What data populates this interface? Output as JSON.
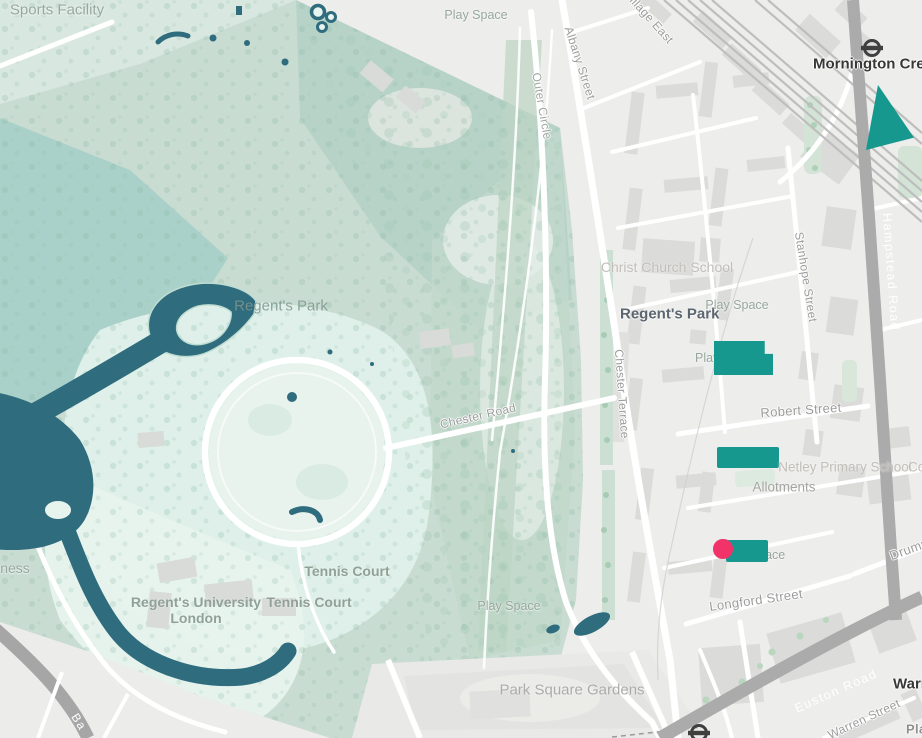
{
  "map": {
    "labels": {
      "sports_facility": "Sports Facility",
      "play_space_top": "Play Space",
      "village_east": "Village East",
      "albany_street": "Albany Street",
      "outer_circle": "Outer Circle",
      "mornington_crescent_station": "Mornington Crescent",
      "christ_church_school": "Christ Church School",
      "regents_park_district": "Regent's Park",
      "regents_park_park": "Regent's Park",
      "play_space_estate_north": "Play Space",
      "stanhope_street": "Stanhope Street",
      "hampstead_road": "Hampstead Road",
      "robert_street": "Robert Street",
      "chester_terrace": "Chester Terrace",
      "chester_road": "Chester Road",
      "netley_primary_school": "Netley Primary School",
      "co_partial": "Co",
      "allotments": "Allotments",
      "play_space_under_highlight_north": "Play Space",
      "play_space_under_highlight_south": "Play Space",
      "longford_street": "Longford Street",
      "drummond_street": "Drummond",
      "tennis_court_north": "Tennis Court",
      "tennis_court_south": "Tennis Court",
      "regents_university_line1": "Regent's University",
      "regents_university_line2": "London",
      "play_space_park_south": "Play Space",
      "park_square_gardens": "Park Square Gardens",
      "euston_road": "Euston Road",
      "warren_street_station": "Warren Street",
      "warren_street_road": "Warren Street",
      "business_partial": "Business",
      "ba_partial": "Ba",
      "play_partial_corner": "Play Space"
    },
    "overlay": {
      "highlight_color": "#17988F",
      "marker_color": "#F2336A",
      "lake_color": "#2F6C7E",
      "highlighted_features": [
        "mornington-crescent-triangle",
        "play-space-block-north",
        "estate-block-middle",
        "play-space-block-south"
      ],
      "marker": "selected-location-dot",
      "station_icons": [
        "mornington-crescent-roundel",
        "warren-street-roundel"
      ]
    },
    "colors": {
      "park_base": "#C9DCD2",
      "park_teal": "#A9D0C8",
      "park_pale": "#E2F1EB",
      "urban_background": "#EDEDEB",
      "building": "#DBDBD9",
      "road_major": "#ABABAB",
      "road_minor": "#FFFFFF",
      "rail": "#BEBEBE",
      "street_label": "#9C9C9C",
      "poi_label": "#C2BEB8",
      "station_label": "#373737"
    }
  }
}
